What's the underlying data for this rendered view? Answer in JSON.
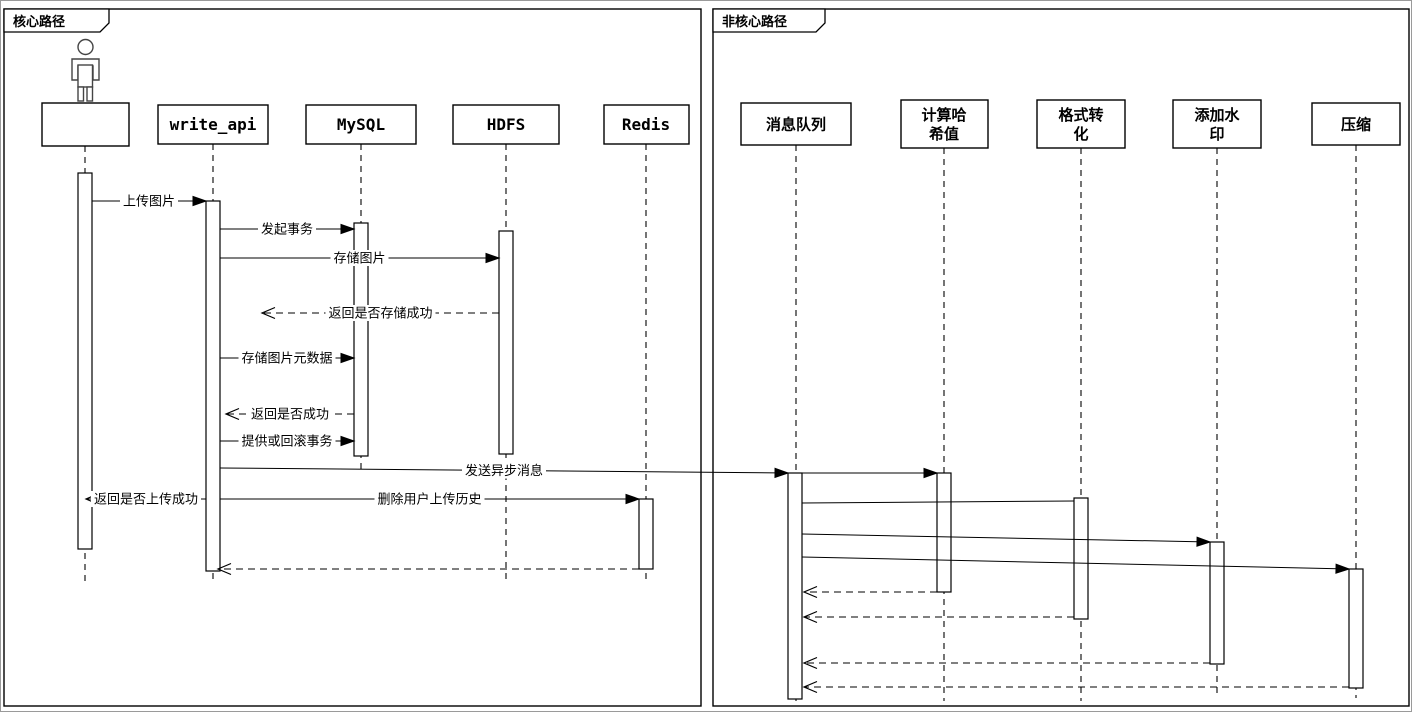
{
  "diagram": {
    "canvas": {
      "width": 1412,
      "height": 712,
      "background": "#ffffff",
      "line_color": "#000000",
      "lifeline_color": "#3a3a3a",
      "border_color": "#9a9a9a"
    },
    "frames": [
      {
        "id": "core-path",
        "label": "核心路径",
        "x": 3,
        "y": 8,
        "w": 697,
        "h": 697,
        "tab_w": 105,
        "tab_h": 23
      },
      {
        "id": "non-core-path",
        "label": "非核心路径",
        "x": 712,
        "y": 8,
        "w": 696,
        "h": 697,
        "tab_w": 112,
        "tab_h": 23
      }
    ],
    "participants": [
      {
        "id": "user",
        "lines": [],
        "cx": 84,
        "box": {
          "x": 41,
          "y": 102,
          "w": 87,
          "h": 43
        },
        "actor": true,
        "lifeline_end": 582
      },
      {
        "id": "write-api",
        "lines": [
          "write_api"
        ],
        "cx": 212,
        "box": {
          "x": 157,
          "y": 104,
          "w": 110,
          "h": 39
        },
        "mono": true,
        "lifeline_end": 582
      },
      {
        "id": "mysql",
        "lines": [
          "MySQL"
        ],
        "cx": 360,
        "box": {
          "x": 305,
          "y": 104,
          "w": 110,
          "h": 39
        },
        "mono": true,
        "lifeline_end": 470
      },
      {
        "id": "hdfs",
        "lines": [
          "HDFS"
        ],
        "cx": 505,
        "box": {
          "x": 452,
          "y": 104,
          "w": 106,
          "h": 39
        },
        "mono": true,
        "lifeline_end": 582
      },
      {
        "id": "redis",
        "lines": [
          "Redis"
        ],
        "cx": 645,
        "box": {
          "x": 603,
          "y": 104,
          "w": 85,
          "h": 39
        },
        "mono": true,
        "lifeline_end": 582
      },
      {
        "id": "message-queue",
        "lines": [
          "消息队列"
        ],
        "cx": 795,
        "box": {
          "x": 740,
          "y": 102,
          "w": 110,
          "h": 42
        },
        "lifeline_end": 700
      },
      {
        "id": "compute-hash",
        "lines": [
          "计算哈",
          "希值"
        ],
        "cx": 943,
        "box": {
          "x": 900,
          "y": 99,
          "w": 87,
          "h": 48
        },
        "lifeline_end": 700
      },
      {
        "id": "format-convert",
        "lines": [
          "格式转",
          "化"
        ],
        "cx": 1080,
        "box": {
          "x": 1036,
          "y": 99,
          "w": 88,
          "h": 48
        },
        "lifeline_end": 700
      },
      {
        "id": "add-watermark",
        "lines": [
          "添加水",
          "印"
        ],
        "cx": 1216,
        "box": {
          "x": 1172,
          "y": 99,
          "w": 88,
          "h": 48
        },
        "lifeline_end": 697
      },
      {
        "id": "compress",
        "lines": [
          "压缩"
        ],
        "cx": 1355,
        "box": {
          "x": 1311,
          "y": 102,
          "w": 88,
          "h": 42
        },
        "lifeline_end": 697
      }
    ],
    "activations": [
      {
        "id": "user-activation",
        "x": 77,
        "y": 172,
        "w": 14,
        "h": 376
      },
      {
        "id": "write-api-activation",
        "x": 205,
        "y": 200,
        "w": 14,
        "h": 370
      },
      {
        "id": "mysql-activation",
        "x": 353,
        "y": 222,
        "w": 14,
        "h": 233
      },
      {
        "id": "hdfs-activation",
        "x": 498,
        "y": 230,
        "w": 14,
        "h": 223
      },
      {
        "id": "redis-activation",
        "x": 638,
        "y": 498,
        "w": 14,
        "h": 70
      },
      {
        "id": "message-queue-activation",
        "x": 787,
        "y": 472,
        "w": 14,
        "h": 226
      },
      {
        "id": "compute-hash-activation",
        "x": 936,
        "y": 472,
        "w": 14,
        "h": 119
      },
      {
        "id": "format-convert-activation",
        "x": 1073,
        "y": 497,
        "w": 14,
        "h": 121
      },
      {
        "id": "add-watermark-activation",
        "x": 1209,
        "y": 541,
        "w": 14,
        "h": 122
      },
      {
        "id": "compress-activation",
        "x": 1348,
        "y": 568,
        "w": 14,
        "h": 119
      }
    ],
    "messages": [
      {
        "id": "upload-image",
        "label": "上传图片",
        "x1": 91,
        "y1": 200,
        "x2": 205,
        "y2": 200,
        "line": "solid",
        "arrow": "filled"
      },
      {
        "id": "begin-transaction",
        "label": "发起事务",
        "x1": 219,
        "y1": 228,
        "x2": 353,
        "y2": 228,
        "line": "solid",
        "arrow": "filled"
      },
      {
        "id": "store-image",
        "label": "存储图片",
        "x1": 219,
        "y1": 257,
        "x2": 498,
        "y2": 257,
        "line": "solid",
        "arrow": "filled"
      },
      {
        "id": "return-store-result",
        "label": "返回是否存储成功",
        "x1": 498,
        "y1": 312,
        "x2": 261,
        "y2": 312,
        "line": "dashed",
        "arrow": "open"
      },
      {
        "id": "store-image-metadata",
        "label": "存储图片元数据",
        "x1": 219,
        "y1": 357,
        "x2": 353,
        "y2": 357,
        "line": "solid",
        "arrow": "filled"
      },
      {
        "id": "return-result",
        "label": "返回是否成功",
        "x1": 353,
        "y1": 413,
        "x2": 225,
        "y2": 413,
        "line": "dashed",
        "arrow": "open"
      },
      {
        "id": "commit-or-rollback",
        "label": "提供或回滚事务",
        "x1": 219,
        "y1": 440,
        "x2": 353,
        "y2": 440,
        "line": "solid",
        "arrow": "filled"
      },
      {
        "id": "send-async-message",
        "label": "发送异步消息",
        "x1": 219,
        "y1": 467,
        "x2": 787,
        "y2": 472,
        "line": "solid",
        "arrow": "filled"
      },
      {
        "id": "return-upload-result",
        "label": "返回是否上传成功",
        "x1": 205,
        "y1": 498,
        "x2": 85,
        "y2": 498,
        "line": "solid",
        "arrow": "open"
      },
      {
        "id": "delete-upload-history",
        "label": "删除用户上传历史",
        "x1": 219,
        "y1": 498,
        "x2": 638,
        "y2": 498,
        "line": "solid",
        "arrow": "filled"
      },
      {
        "id": "redis-return",
        "label": "",
        "x1": 638,
        "y1": 568,
        "x2": 217,
        "y2": 568,
        "line": "dashed",
        "arrow": "open"
      },
      {
        "id": "mq-to-hash",
        "label": "",
        "x1": 801,
        "y1": 472,
        "x2": 936,
        "y2": 472,
        "line": "solid",
        "arrow": "filled"
      },
      {
        "id": "mq-to-format",
        "label": "",
        "x1": 801,
        "y1": 502,
        "x2": 1073,
        "y2": 500,
        "line": "solid",
        "arrow": "none"
      },
      {
        "id": "mq-to-watermark",
        "label": "",
        "x1": 801,
        "y1": 533,
        "x2": 1209,
        "y2": 541,
        "line": "solid",
        "arrow": "filled"
      },
      {
        "id": "mq-to-compress",
        "label": "",
        "x1": 801,
        "y1": 556,
        "x2": 1348,
        "y2": 568,
        "line": "solid",
        "arrow": "filled"
      },
      {
        "id": "hash-return",
        "label": "",
        "x1": 936,
        "y1": 591,
        "x2": 803,
        "y2": 591,
        "line": "dashed",
        "arrow": "open"
      },
      {
        "id": "format-return",
        "label": "",
        "x1": 1073,
        "y1": 616,
        "x2": 803,
        "y2": 616,
        "line": "dashed",
        "arrow": "open"
      },
      {
        "id": "watermark-return",
        "label": "",
        "x1": 1209,
        "y1": 662,
        "x2": 803,
        "y2": 662,
        "line": "dashed",
        "arrow": "open"
      },
      {
        "id": "compress-return",
        "label": "",
        "x1": 1348,
        "y1": 686,
        "x2": 803,
        "y2": 686,
        "line": "dashed",
        "arrow": "open"
      }
    ]
  }
}
